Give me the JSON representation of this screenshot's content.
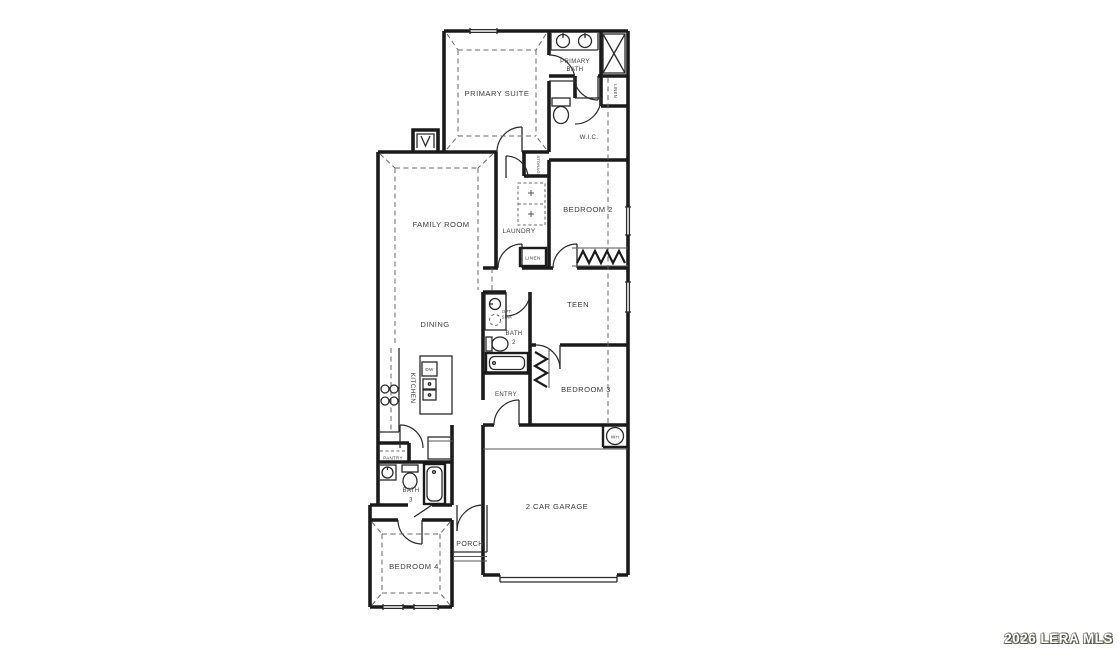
{
  "watermark": {
    "text": "2026 LERA MLS"
  },
  "colors": {
    "wall": "#1b1b1b",
    "label": "#3c3c3c",
    "background": "#ffffff"
  },
  "rooms": {
    "primary_suite": "PRIMARY SUITE",
    "primary_bath_line1": "PRIMARY",
    "primary_bath_line2": "BATH",
    "wic": "W.I.C.",
    "linen_primary": "LINEN",
    "bedroom2": "BEDROOM 2",
    "laundry": "LAUNDRY",
    "storage": "STORAGE",
    "linen_hall": "LINEN",
    "family_room": "FAMILY ROOM",
    "dining": "DINING",
    "kitchen": "KITCHEN",
    "teen": "TEEN",
    "bath2_line1": "BATH",
    "bath2_line2": "2",
    "opt_sink_line1": "OPT.",
    "opt_sink_line2": "SINK",
    "bedroom3": "BEDROOM 3",
    "entry": "ENTRY",
    "pantry": "PANTRY",
    "bath3_line1": "BATH",
    "bath3_line2": "3",
    "bedroom4": "BEDROOM 4",
    "porch": "PORCH",
    "garage": "2 CAR GARAGE"
  },
  "fixtures": {
    "dishwasher": "DW",
    "water_heater": "WH"
  }
}
